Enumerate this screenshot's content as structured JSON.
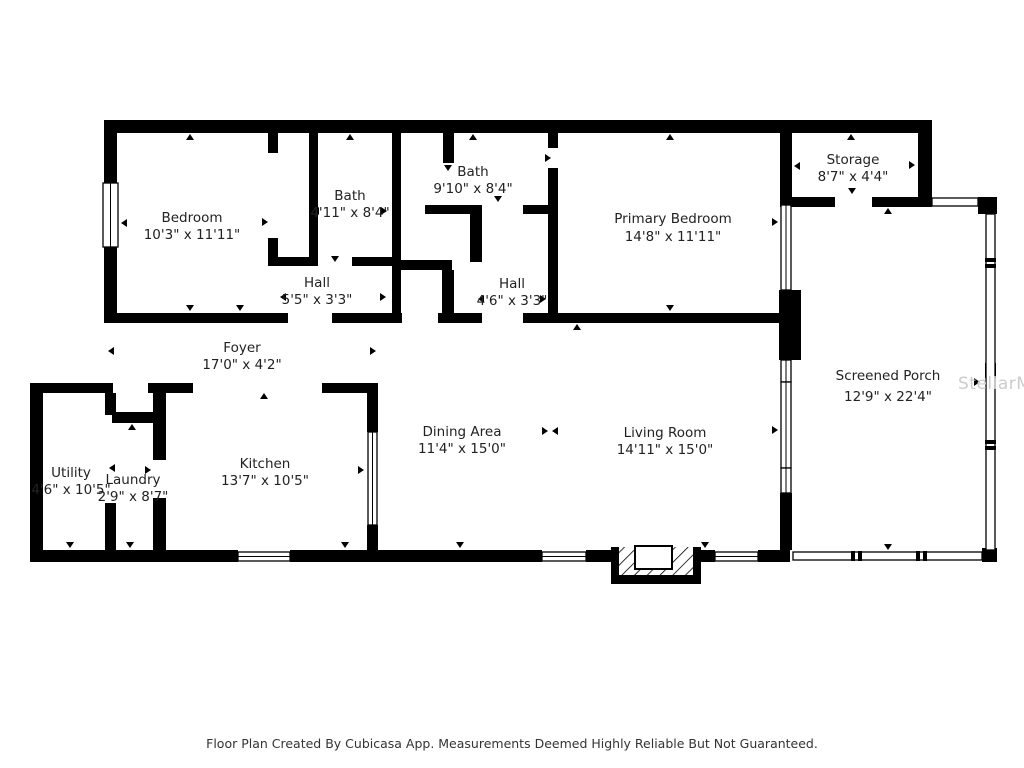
{
  "title": "Floor Plan",
  "rooms": [
    {
      "name": "Bedroom",
      "dims": "10'3\" x 11'11\""
    },
    {
      "name": "Bath",
      "dims": "4'11\" x 8'4\""
    },
    {
      "name": "Bath",
      "dims": "9'10\" x 8'4\""
    },
    {
      "name": "Hall",
      "dims": "5'5\" x 3'3\""
    },
    {
      "name": "Hall",
      "dims": "4'6\" x 3'3\""
    },
    {
      "name": "Primary Bedroom",
      "dims": "14'8\" x 11'11\""
    },
    {
      "name": "Storage",
      "dims": "8'7\" x 4'4\""
    },
    {
      "name": "Screened Porch",
      "dims": "12'9\" x 22'4\""
    },
    {
      "name": "Foyer",
      "dims": "17'0\" x 4'2\""
    },
    {
      "name": "Utility",
      "dims": "4'6\" x 10'5\""
    },
    {
      "name": "Laundry",
      "dims": "2'9\" x 8'7\""
    },
    {
      "name": "Kitchen",
      "dims": "13'7\" x 10'5\""
    },
    {
      "name": "Dining Area",
      "dims": "11'4\" x 15'0\""
    },
    {
      "name": "Living Room",
      "dims": "14'11\" x 15'0\""
    }
  ],
  "footer": {
    "text": "Floor Plan Created By Cubicasa App. Measurements Deemed Highly Reliable But Not Guaranteed."
  },
  "watermark": {
    "text": "StellarMLS"
  },
  "colors": {
    "wall": "#000000",
    "text": "#222222",
    "watermark": "#cccccc",
    "background": "#ffffff"
  }
}
